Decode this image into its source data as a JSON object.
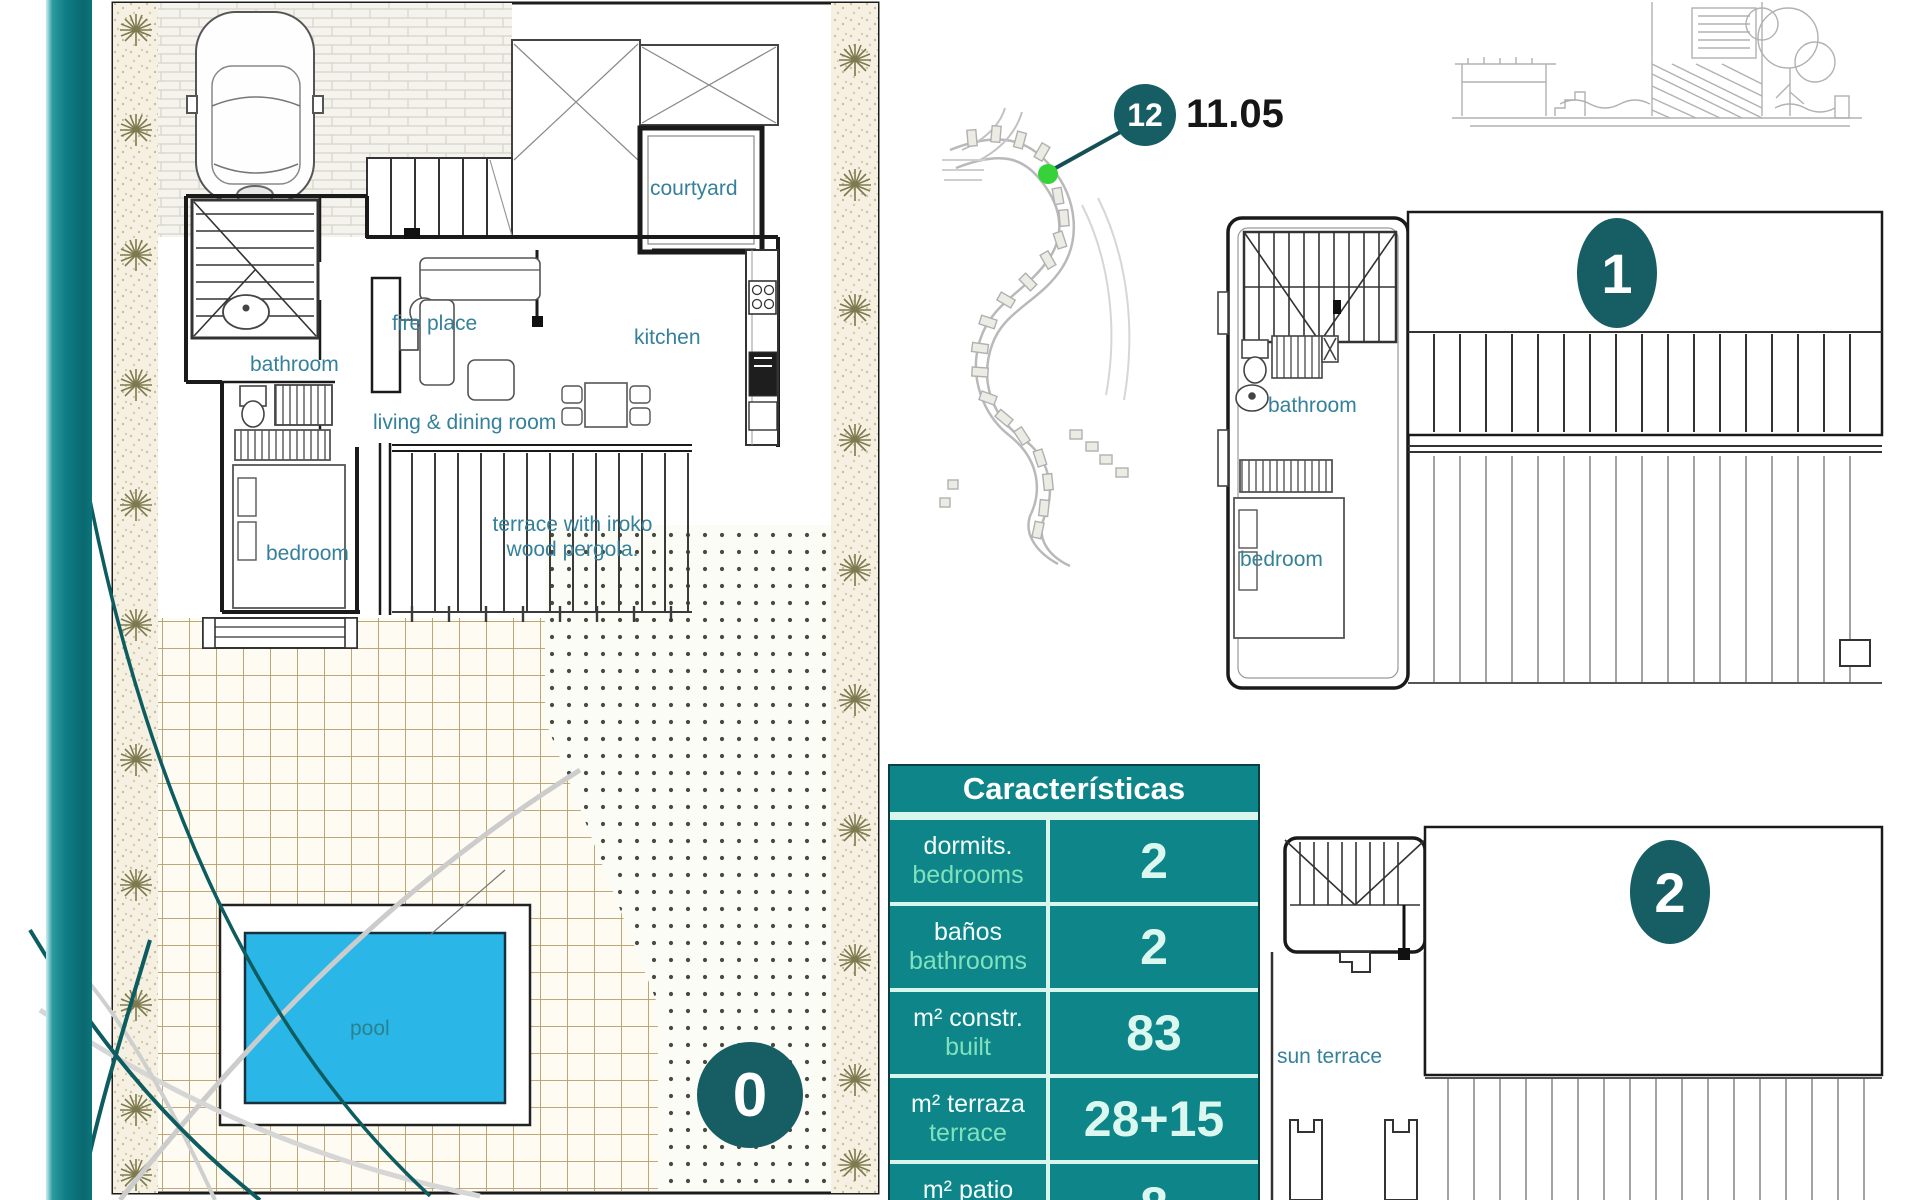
{
  "ground_floor": {
    "badge": "0",
    "labels": {
      "courtyard": "courtyard",
      "fire_place": "fire place",
      "kitchen": "kitchen",
      "bathroom": "bathroom",
      "living_dining": "living & dining room",
      "bedroom": "bedroom",
      "terrace_line1": "terrace with iroko",
      "terrace_line2": "wood pergola.",
      "pool": "pool"
    }
  },
  "site_map": {
    "badge": "12",
    "elevation": "11.05"
  },
  "floor_1": {
    "badge": "1",
    "labels": {
      "bathroom": "bathroom",
      "bedroom": "bedroom"
    }
  },
  "floor_2": {
    "badge": "2",
    "labels": {
      "sun_terrace": "sun terrace"
    }
  },
  "characteristics_table": {
    "title": "Características",
    "rows": [
      {
        "label_es": "dormits.",
        "label_en": "bedrooms",
        "value": "2"
      },
      {
        "label_es": "baños",
        "label_en": "bathrooms",
        "value": "2"
      },
      {
        "label_es": "m² constr.",
        "label_en": "built",
        "value": "83"
      },
      {
        "label_es": "m² terraza",
        "label_en": "terrace",
        "value": "28+15"
      },
      {
        "label_es": "m² patio",
        "label_en": "courtyard",
        "value": "8"
      }
    ]
  },
  "colors": {
    "accent_teal": "#0e8589",
    "badge_teal": "#175d64",
    "label_blue": "#35809a",
    "pool_water": "#2ab7e8",
    "marker_green": "#37d23a"
  }
}
